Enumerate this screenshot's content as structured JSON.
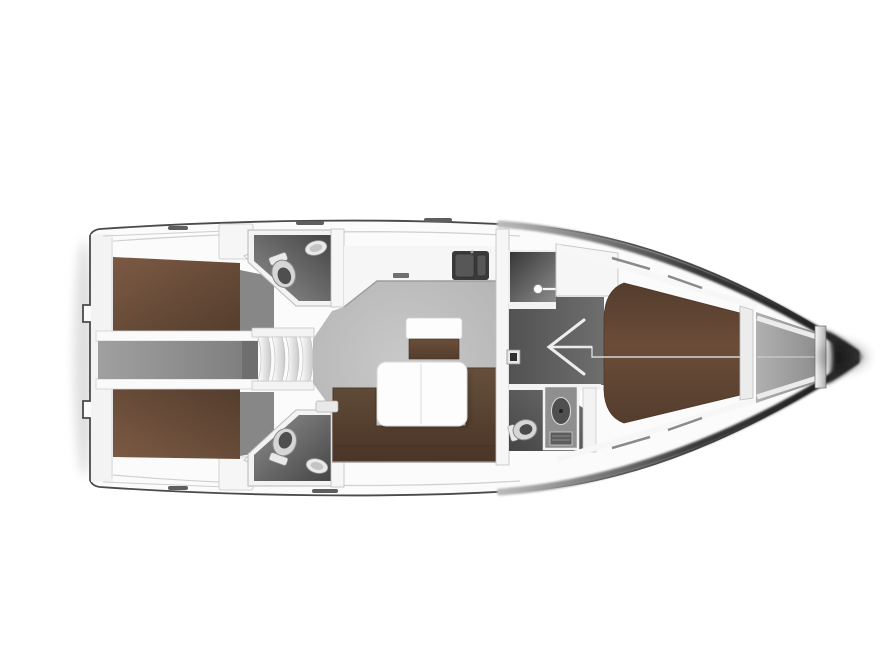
{
  "diagram": {
    "type": "yacht-interior-floor-plan",
    "title": "Sailing yacht interior layout plan, top view, bow pointing right",
    "orientation": {
      "bow": "right",
      "stern": "left"
    },
    "colors": {
      "background": "#ffffff",
      "hull_fill": "#fbfbfb",
      "hull_line": "#4a4a4a",
      "edge_fade": "#b9b9b9",
      "deck_white": "#f3f3f3",
      "wall_white": "#f6f6f6",
      "bed_light": "#7b5a44",
      "bed_mid": "#6b4c39",
      "bed_dark": "#543d2d",
      "sofa_light": "#66503c",
      "sofa_dark": "#4a3527",
      "cabinet_light": "#6a4e3a",
      "cabinet_dark": "#543d2c",
      "table_white": "#fdfdfd",
      "salon_light": "#c9c9c9",
      "salon_dark": "#b0b0b0",
      "corridor_light": "#a0a0a0",
      "corridor_dark": "#7c7c7c",
      "wardrobe_gray": "#878787",
      "wet_light": "#8f8f8f",
      "wet_dark": "#454545",
      "shower_dark": "#353535",
      "passage_light": "#6e6e6e",
      "passage_dark": "#525252",
      "locker_light": "#b0b0b0",
      "locker_dark": "#8e8e8e",
      "fixture_light": "#e9e9e9",
      "fixture_mid": "#c9c9c9",
      "fixture_dark": "#b5b5b5",
      "sink_dark": "#3a3a3a",
      "bow_shadow": "#1a1a1a",
      "steel_dark": "#555555",
      "shadow_soft": "#d7d7d7"
    },
    "components": {
      "rooms": [
        {
          "id": "aft-cabin-port",
          "name": "aft double cabin (top)"
        },
        {
          "id": "aft-cabin-starboard",
          "name": "aft double cabin (bottom)"
        },
        {
          "id": "aft-head-port",
          "name": "aft bathroom (top)"
        },
        {
          "id": "aft-head-starboard",
          "name": "aft bathroom (bottom)"
        },
        {
          "id": "saloon",
          "name": "saloon with U-sofa and table"
        },
        {
          "id": "galley",
          "name": "galley with double sink"
        },
        {
          "id": "companionway",
          "name": "companionway steps"
        },
        {
          "id": "shower-room",
          "name": "separate shower room"
        },
        {
          "id": "forward-head",
          "name": "forward bathroom"
        },
        {
          "id": "forward-cabin",
          "name": "forward V-berth cabin"
        },
        {
          "id": "anchor-locker",
          "name": "bow anchor locker"
        }
      ],
      "icons": [
        "toilet-icon",
        "sink-icon",
        "shower-head-icon",
        "door-swing-icon",
        "steps-icon",
        "double-sink-icon",
        "deck-hatch-icon"
      ]
    }
  }
}
